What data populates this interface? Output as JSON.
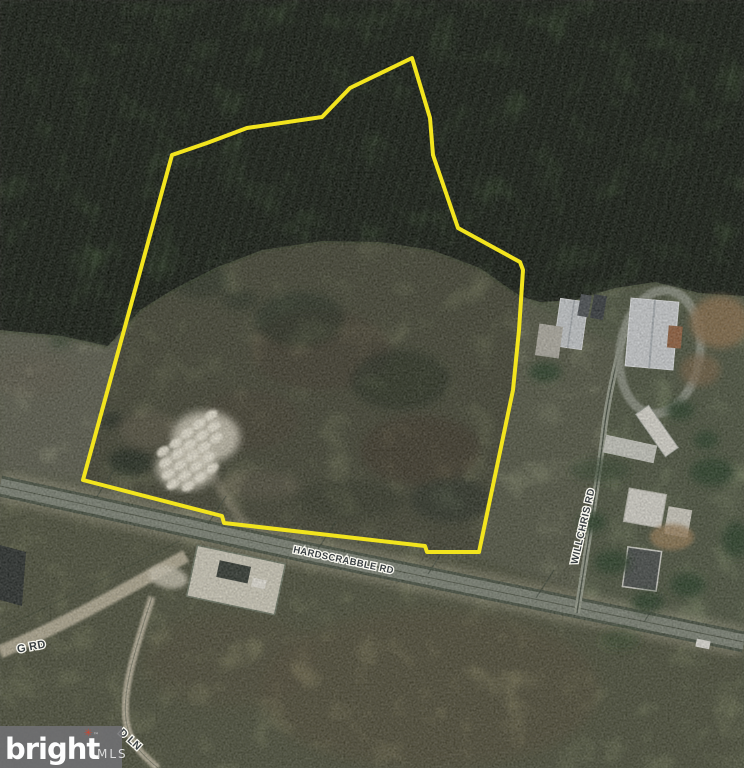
{
  "scene": {
    "description": "Aerial photo of wooded land parcel with yellow boundary outline",
    "parcel": {
      "outline_color": "#f2e41e",
      "outline_points": "412,58 350,88 322,117 247,128 207,143 172,155 83,480 222,516 224,523 425,546 427,552 479,552 513,390 519,330 523,270 520,262 458,228 433,155 430,118"
    },
    "road_labels": {
      "main": "HARDSCRABBLE RD",
      "side": "WILLCHRIS RD",
      "left_partial": "G RD",
      "lane_partial": "D LN"
    }
  },
  "watermark": {
    "brand": "bright",
    "trademark": "™",
    "suffix": "MLS",
    "accent_glyph": "✳",
    "accent_color": "#cc4631",
    "box_color": "#717174"
  }
}
